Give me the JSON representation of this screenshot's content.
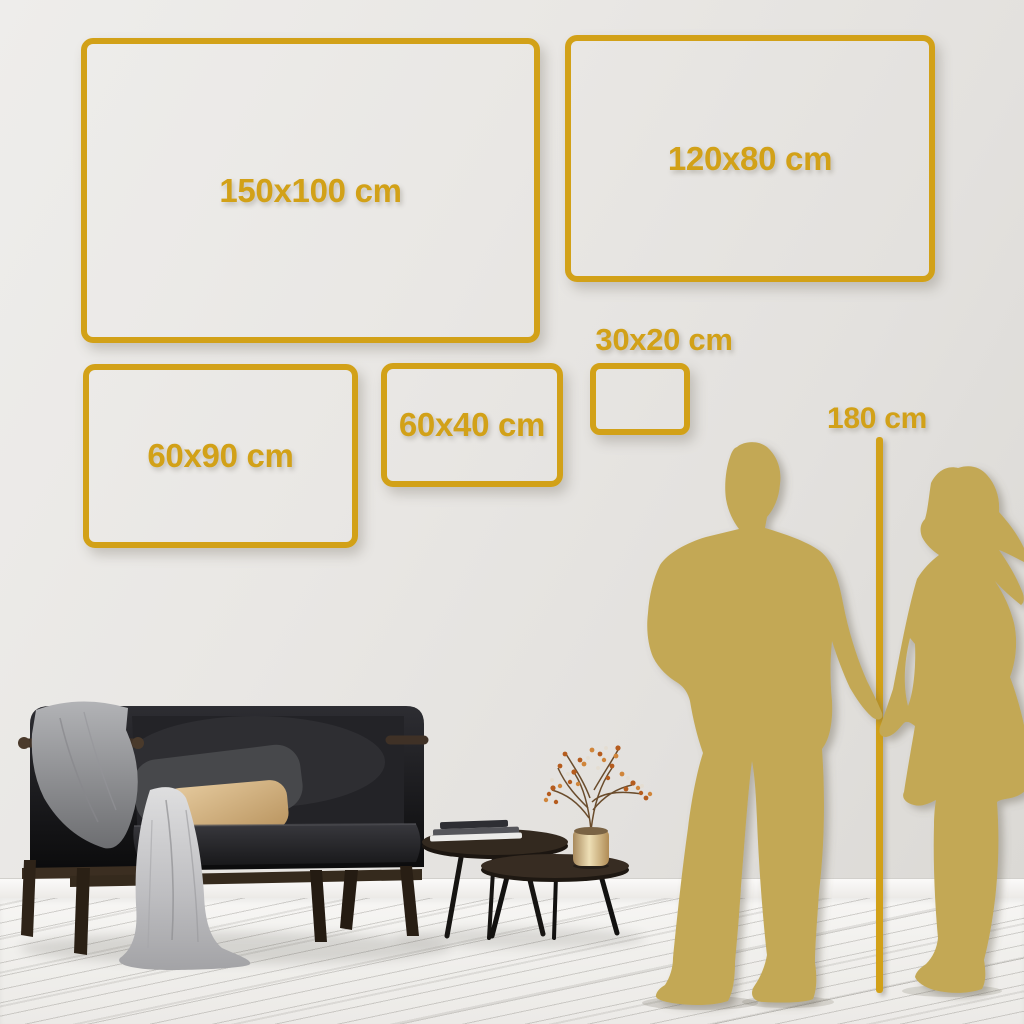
{
  "colors": {
    "gold": "#d2a118",
    "silhouette": "#c3a854",
    "wall": "#e7e5e2",
    "floor": "#f0efec"
  },
  "frames": [
    {
      "id": "150x100",
      "label": "150x100 cm",
      "width_cm": 150,
      "height_cm": 100
    },
    {
      "id": "120x80",
      "label": "120x80 cm",
      "width_cm": 120,
      "height_cm": 80
    },
    {
      "id": "60x90",
      "label": "60x90 cm",
      "width_cm": 60,
      "height_cm": 90
    },
    {
      "id": "60x40",
      "label": "60x40 cm",
      "width_cm": 60,
      "height_cm": 40
    },
    {
      "id": "30x20",
      "label": "30x20 cm",
      "width_cm": 30,
      "height_cm": 20
    }
  ],
  "height_reference": {
    "label": "180 cm",
    "value_cm": 180
  }
}
